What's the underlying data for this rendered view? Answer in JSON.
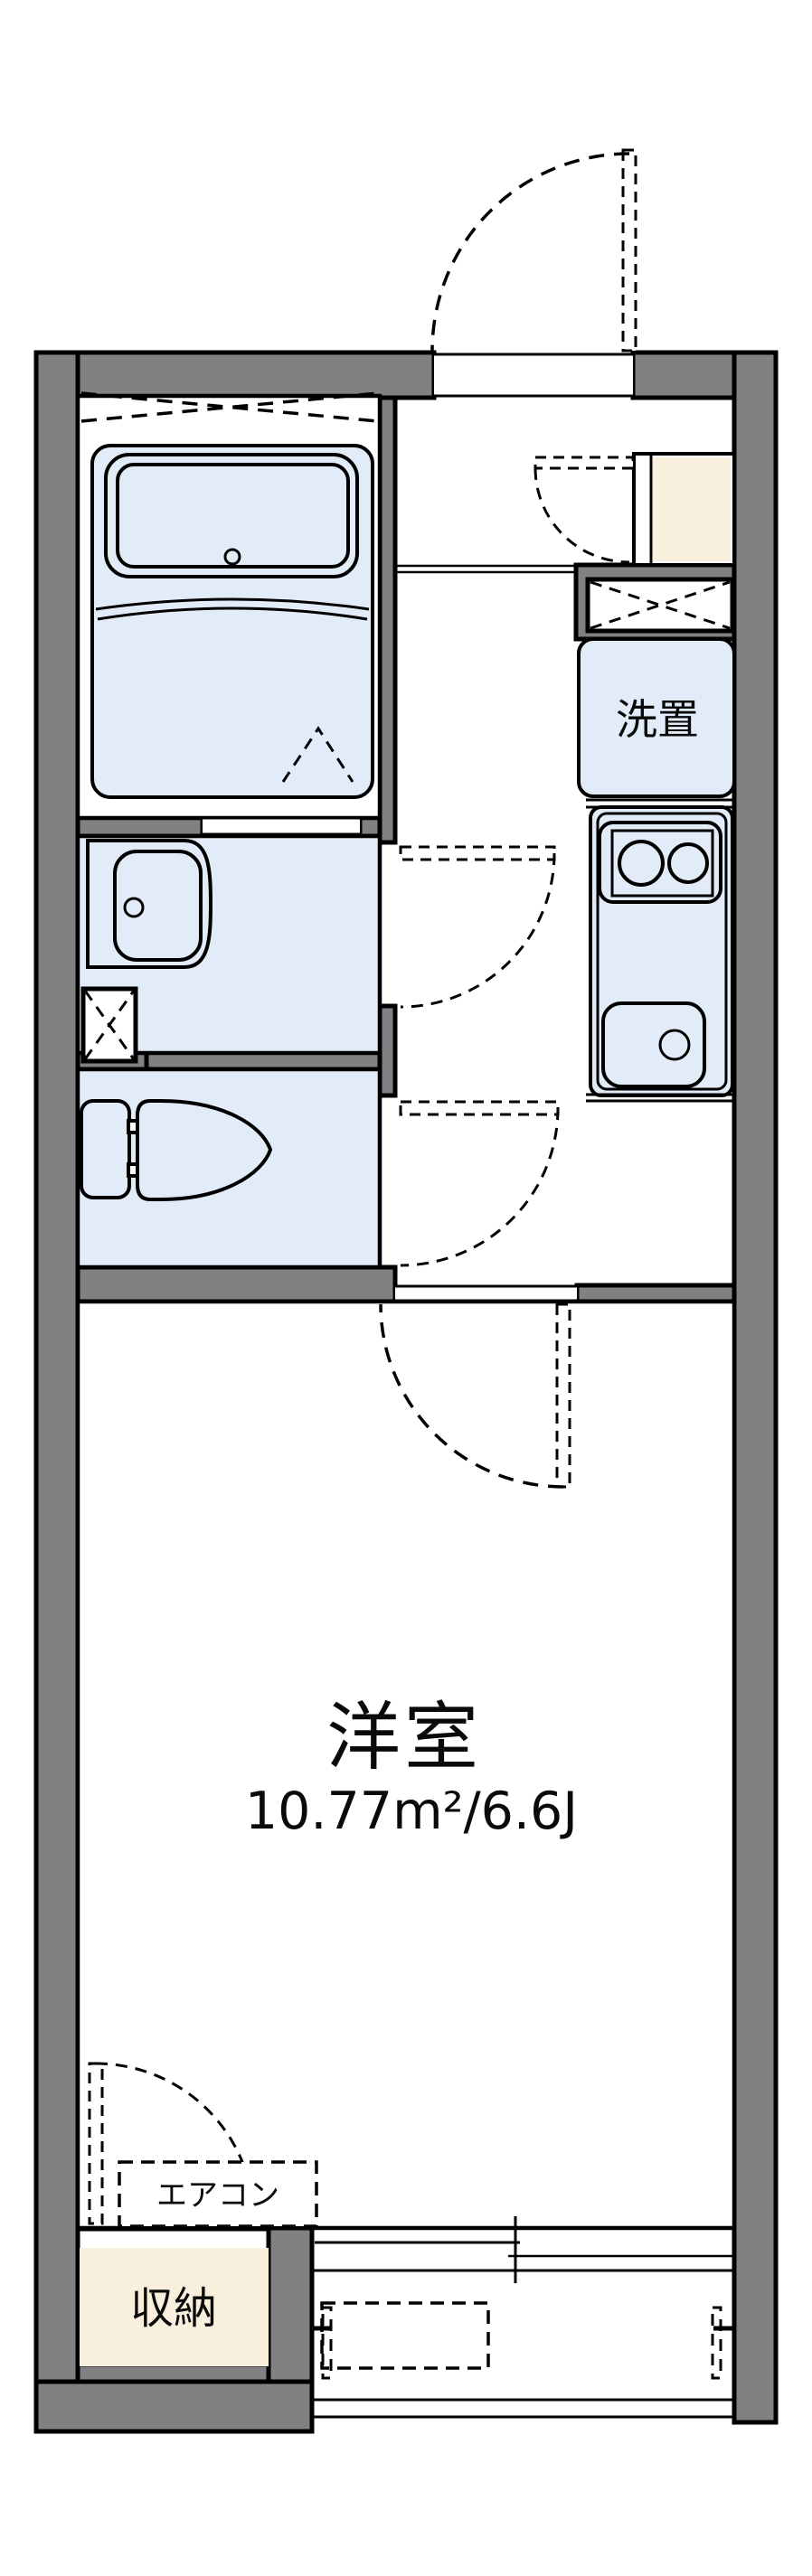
{
  "plan": {
    "type": "floorplan",
    "labels": {
      "main_room": "洋室",
      "main_room_area": "10.77m²/6.6J",
      "washer_place": "洗置",
      "aircon": "エアコン",
      "storage": "収納"
    },
    "rooms": [
      {
        "name": "bath",
        "fixtures": [
          "bathtub",
          "folding-door",
          "window-x"
        ]
      },
      {
        "name": "washroom",
        "fixtures": [
          "washbasin",
          "pipe-space-x"
        ]
      },
      {
        "name": "toilet",
        "fixtures": [
          "toilet-tank",
          "toilet-bowl"
        ]
      },
      {
        "name": "kitchen",
        "fixtures": [
          "two-burner-stove",
          "sink",
          "washer-place"
        ]
      },
      {
        "name": "entry",
        "fixtures": [
          "shoe-cabinet",
          "overhead-storage-x",
          "entry-door"
        ]
      },
      {
        "name": "main-room",
        "fixtures": [
          "aircon-box",
          "closet",
          "sliding-window"
        ]
      },
      {
        "name": "balcony",
        "fixtures": [
          "laundry-pole-brackets"
        ]
      }
    ]
  },
  "colors": {
    "wall": "#818184",
    "blue": "#e2ebf8",
    "cream": "#f8f0dc",
    "line": "#000000",
    "bg": "#ffffff"
  }
}
